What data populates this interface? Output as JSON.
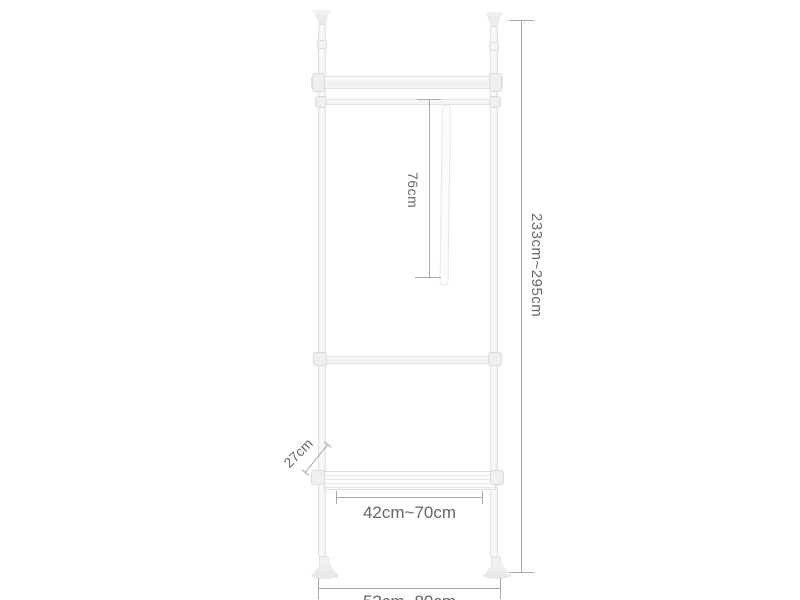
{
  "diagram": {
    "type": "product-dimension-diagram",
    "subject": "telescopic floor-to-ceiling clothes rack with hanger bars and shelf",
    "labels": {
      "hang_drop": "76cm",
      "total_height": "233cm~295cm",
      "shelf_depth": "27cm",
      "bar_width": "42cm~70cm",
      "base_width": "52cm~80cm"
    },
    "colors": {
      "background": "#ffffff",
      "frame_fill": "#f8f8f6",
      "frame_border": "#e2e2e0",
      "dimension_line": "#a8a8a8",
      "label_text": "#666666"
    }
  }
}
